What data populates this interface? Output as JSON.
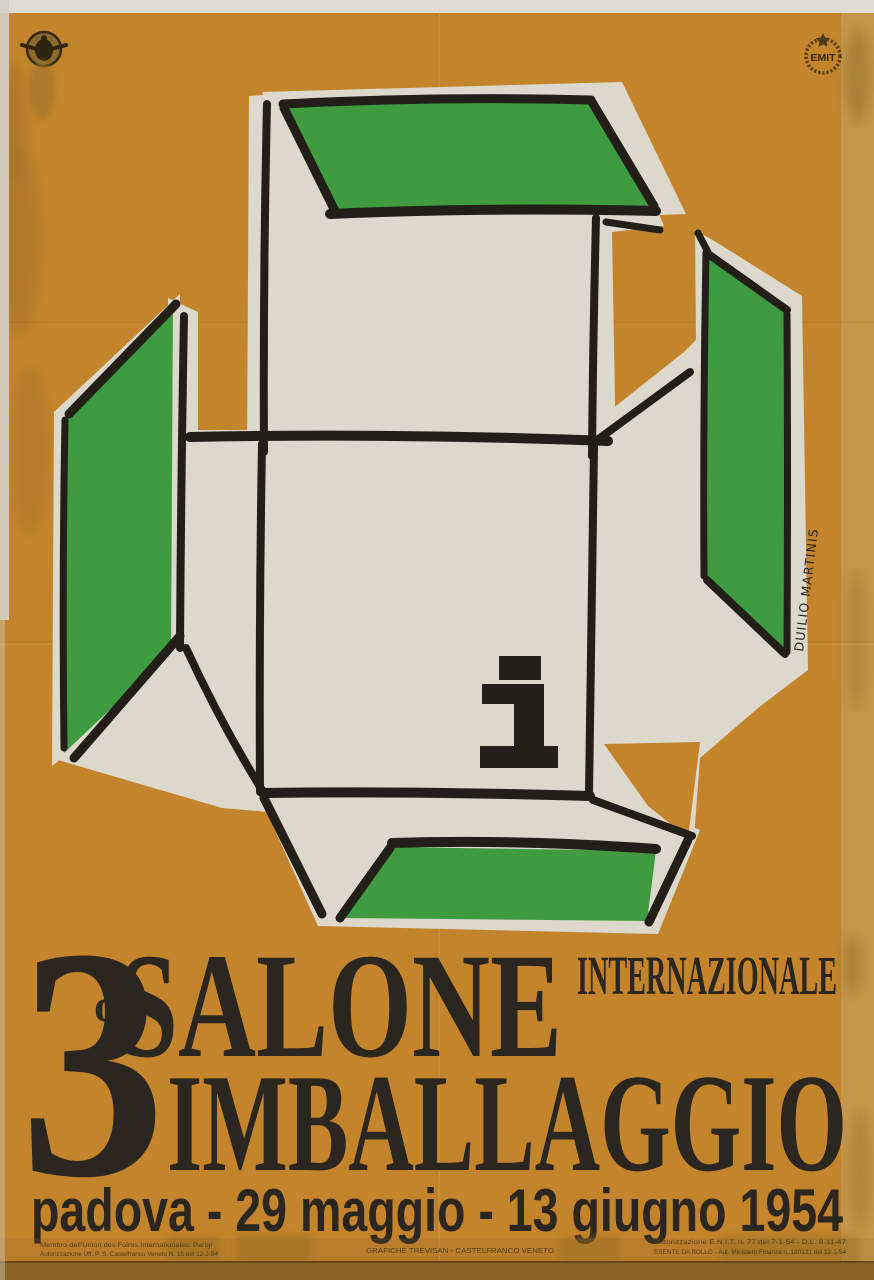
{
  "poster": {
    "title": {
      "number": "3",
      "ordinal": "o",
      "line1": "SALONE",
      "qualifier": "INTERNAZIONALE",
      "line2": "IMBALLAGGIO"
    },
    "date_line": "padova - 29 maggio - 13 giugno 1954",
    "info_mark": "i",
    "signature": "DUILIO MARTINIS",
    "badges": {
      "emit_label": "EMIT"
    },
    "fine_print": {
      "left_line1": "Membro dell'Union des Foires Internationales: Parigi",
      "left_line2": "Autorizzazione Uff. P. S. Castelfranco Veneto N. 15 del 12-2-54",
      "center": "GRAFICHE TREVISAN - CASTELFRANCO VENETO",
      "right_line1": "Autorizzazione E.N.I.T. n. 77 del 7-1-54 - D.L. 8-11-47",
      "right_line2": "ESENTE DA BOLLO - Aut. Ministero Finanze n. 180121 del 12-1-54"
    },
    "colors": {
      "background_ochre": "#c4842c",
      "flap_green": "#3f9b3f",
      "panel_white": "#dcd8cb",
      "ink_black": "#221e18",
      "edge_strip_tan": "#c59a52",
      "bottom_band_brown": "#8a6126"
    }
  }
}
